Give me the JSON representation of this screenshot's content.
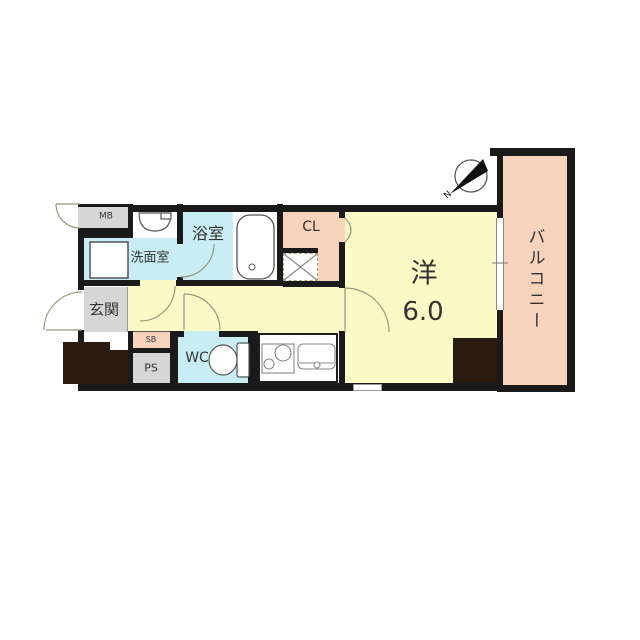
{
  "rooms": {
    "meter_box": {
      "label": "MB"
    },
    "washroom": {
      "label": "洗面室"
    },
    "bathroom": {
      "label": "浴室"
    },
    "closet": {
      "label": "CL"
    },
    "entrance": {
      "label": "玄関"
    },
    "shoe_box": {
      "label": "SB"
    },
    "pipe_space": {
      "label": "PS"
    },
    "toilet": {
      "label": "WC"
    },
    "main_room": {
      "label": "洋",
      "size_tatami": "6.0"
    },
    "balcony": {
      "label": "バルコニー"
    }
  },
  "compass": {
    "label": "N"
  },
  "colors": {
    "bg": "#ffffff",
    "wall": "#1a1a1a",
    "block": "#2a1b10",
    "wet": "#c8edf2",
    "floor": "#fafac6",
    "service": "#f6d3ba",
    "gray": "#d6d6d6",
    "line": "#97977d"
  }
}
